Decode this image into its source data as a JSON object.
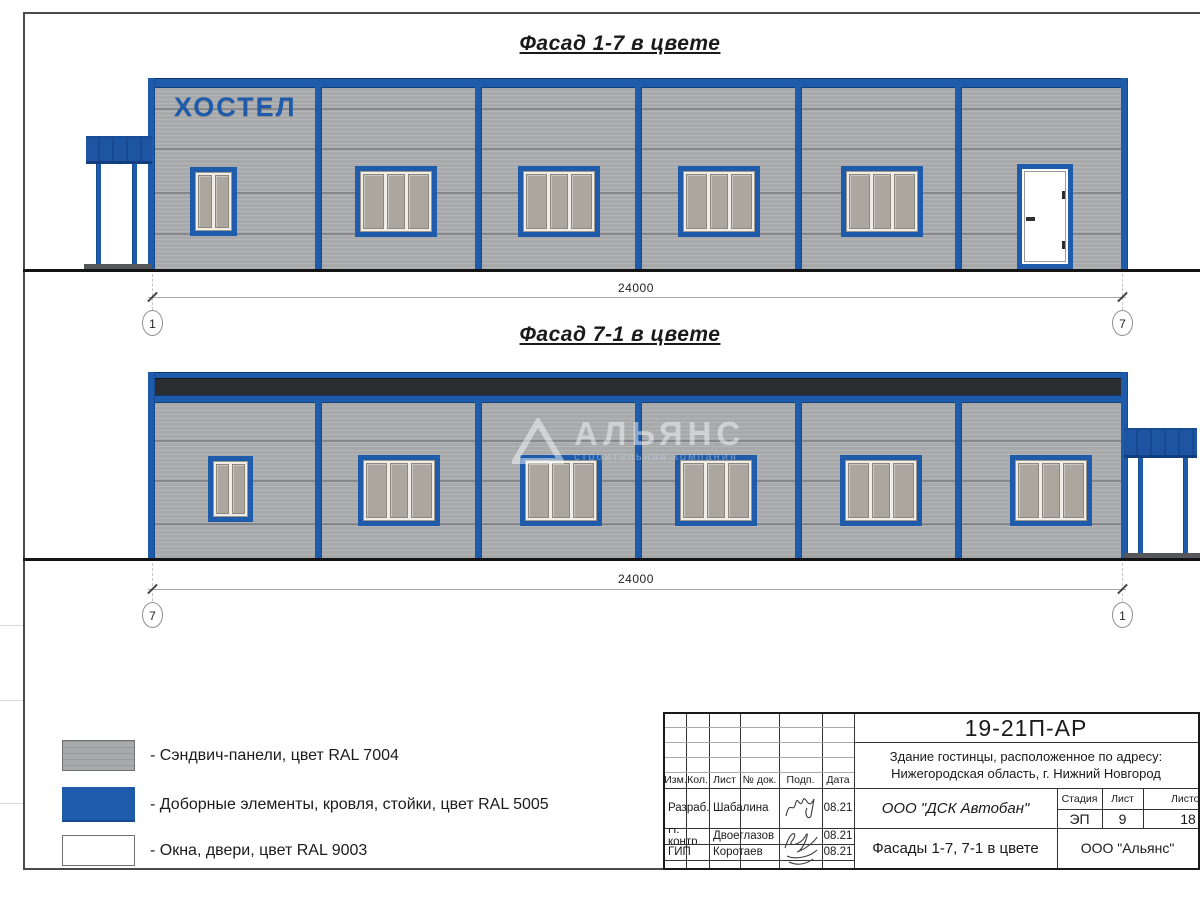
{
  "page": {
    "facade1_title": "Фасад 1-7 в цвете",
    "facade2_title": "Фасад 7-1 в цвете"
  },
  "facade1": {
    "sign": "ХОСТЕЛ",
    "dim": "24000",
    "axis_left": "1",
    "axis_right": "7"
  },
  "facade2": {
    "dim": "24000",
    "axis_left": "7",
    "axis_right": "1"
  },
  "watermark": {
    "title": "АЛЬЯНС",
    "subtitle": "строительная компания"
  },
  "colors": {
    "panels": "#a8a9ab",
    "accent_blue": "#1e5cab",
    "windows_white": "#ffffff",
    "roof_dark": "#2b2d31"
  },
  "legend": [
    {
      "label": "- Сэндвич-панели, цвет RAL 7004"
    },
    {
      "label": "- Доборные элементы, кровля, стойки, цвет RAL 5005"
    },
    {
      "label": "- Окна, двери, цвет RAL 9003"
    }
  ],
  "stamp": {
    "doc_number": "19-21П-АР",
    "address1": "Здание гостинцы, расположенное по адресу:",
    "address2": "Нижегородская область, г. Нижний Новгород",
    "col_izm": "Изм.",
    "col_kol": "Кол.",
    "col_list": "Лист",
    "col_doc": "№ док.",
    "col_sign": "Подп.",
    "col_date": "Дата",
    "rows": [
      {
        "role": "Разраб.",
        "name": "Шабалина",
        "date": "08.21"
      },
      {
        "role": "Н. контр.",
        "name": "Двоеглазов",
        "date": "08.21"
      },
      {
        "role": "ГИП",
        "name": "Коротаев",
        "date": "08.21"
      }
    ],
    "company": "ООО \"ДСК Автобан\"",
    "stage_h": "Стадия",
    "list_h": "Лист",
    "listov_h": "Листов",
    "stage": "ЭП",
    "list": "9",
    "listov": "18",
    "drawing_title": "Фасады 1-7, 7-1 в цвете",
    "org": "ООО \"Альянс\""
  }
}
